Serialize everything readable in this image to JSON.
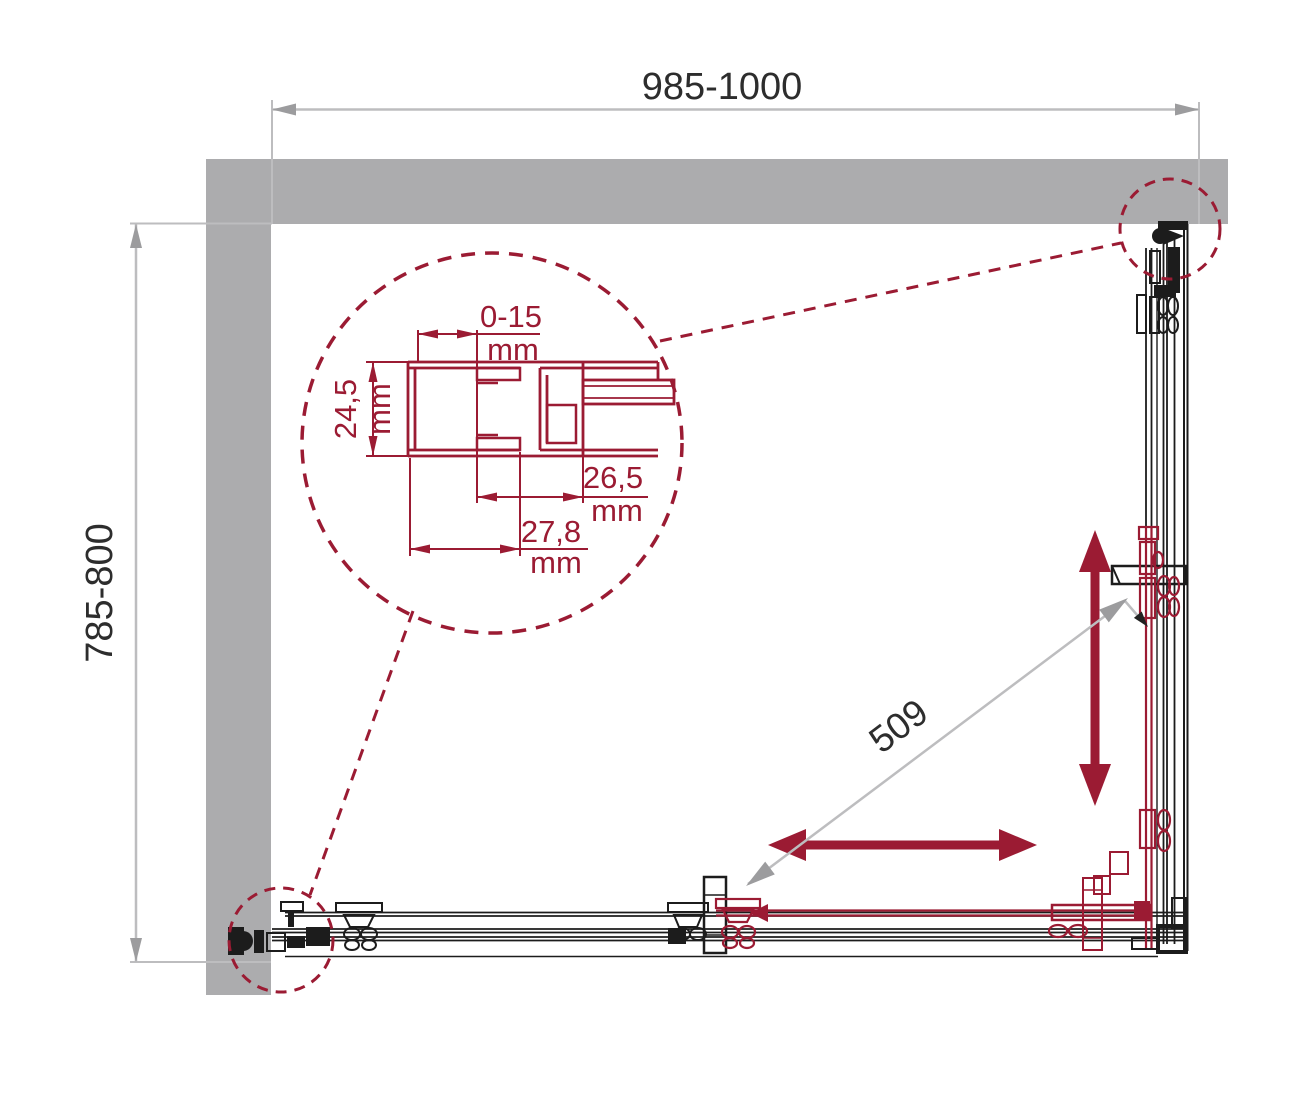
{
  "colors": {
    "wall": "#ACACAE",
    "line": "#1C1C1C",
    "accent": "#9B1B33",
    "dim_line": "#BDBDBF",
    "dim_arrow": "#9C9C9E",
    "text": "#2D2D2D",
    "background": "#FFFFFF"
  },
  "dimensions": {
    "width": "985-1000",
    "depth": "785-800",
    "diagonal": "509"
  },
  "detail": {
    "adjustment_value": "0-15",
    "adjustment_unit": "mm",
    "depth_value": "24,5",
    "depth_unit": "mm",
    "offset_a_value": "26,5",
    "offset_a_unit": "mm",
    "offset_b_value": "27,8",
    "offset_b_unit": "mm"
  }
}
